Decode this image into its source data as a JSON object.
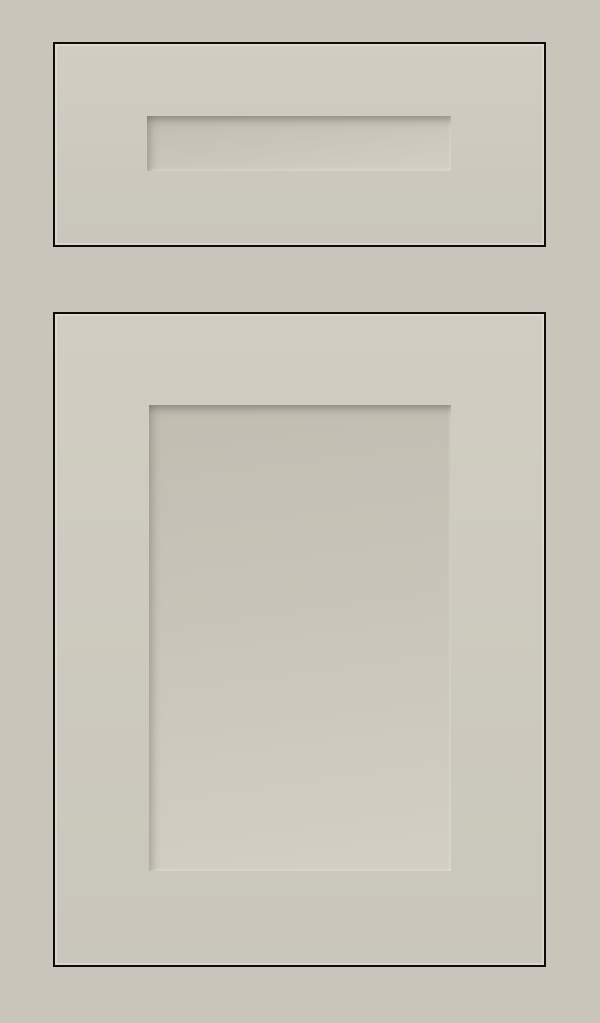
{
  "scene": {
    "parts": [
      {
        "name": "drawer-front"
      },
      {
        "name": "drawer-center-panel"
      },
      {
        "name": "cabinet-door"
      },
      {
        "name": "door-center-panel"
      }
    ]
  },
  "colors": {
    "background": "#c9c5ba",
    "face-top": "#d1cdc2",
    "face-bottom": "#c9c6bb",
    "outline": "#0c0c0b",
    "recess-dark": "#c1bdb1",
    "recess-mid": "#c9c5ba",
    "recess-light": "#d3cfc4",
    "bevel-shadow": "rgba(82,77,67,0.5)",
    "bevel-shadow-soft": "rgba(82,77,67,0.32)",
    "bevel-highlight": "rgba(255,255,255,0.38)"
  }
}
